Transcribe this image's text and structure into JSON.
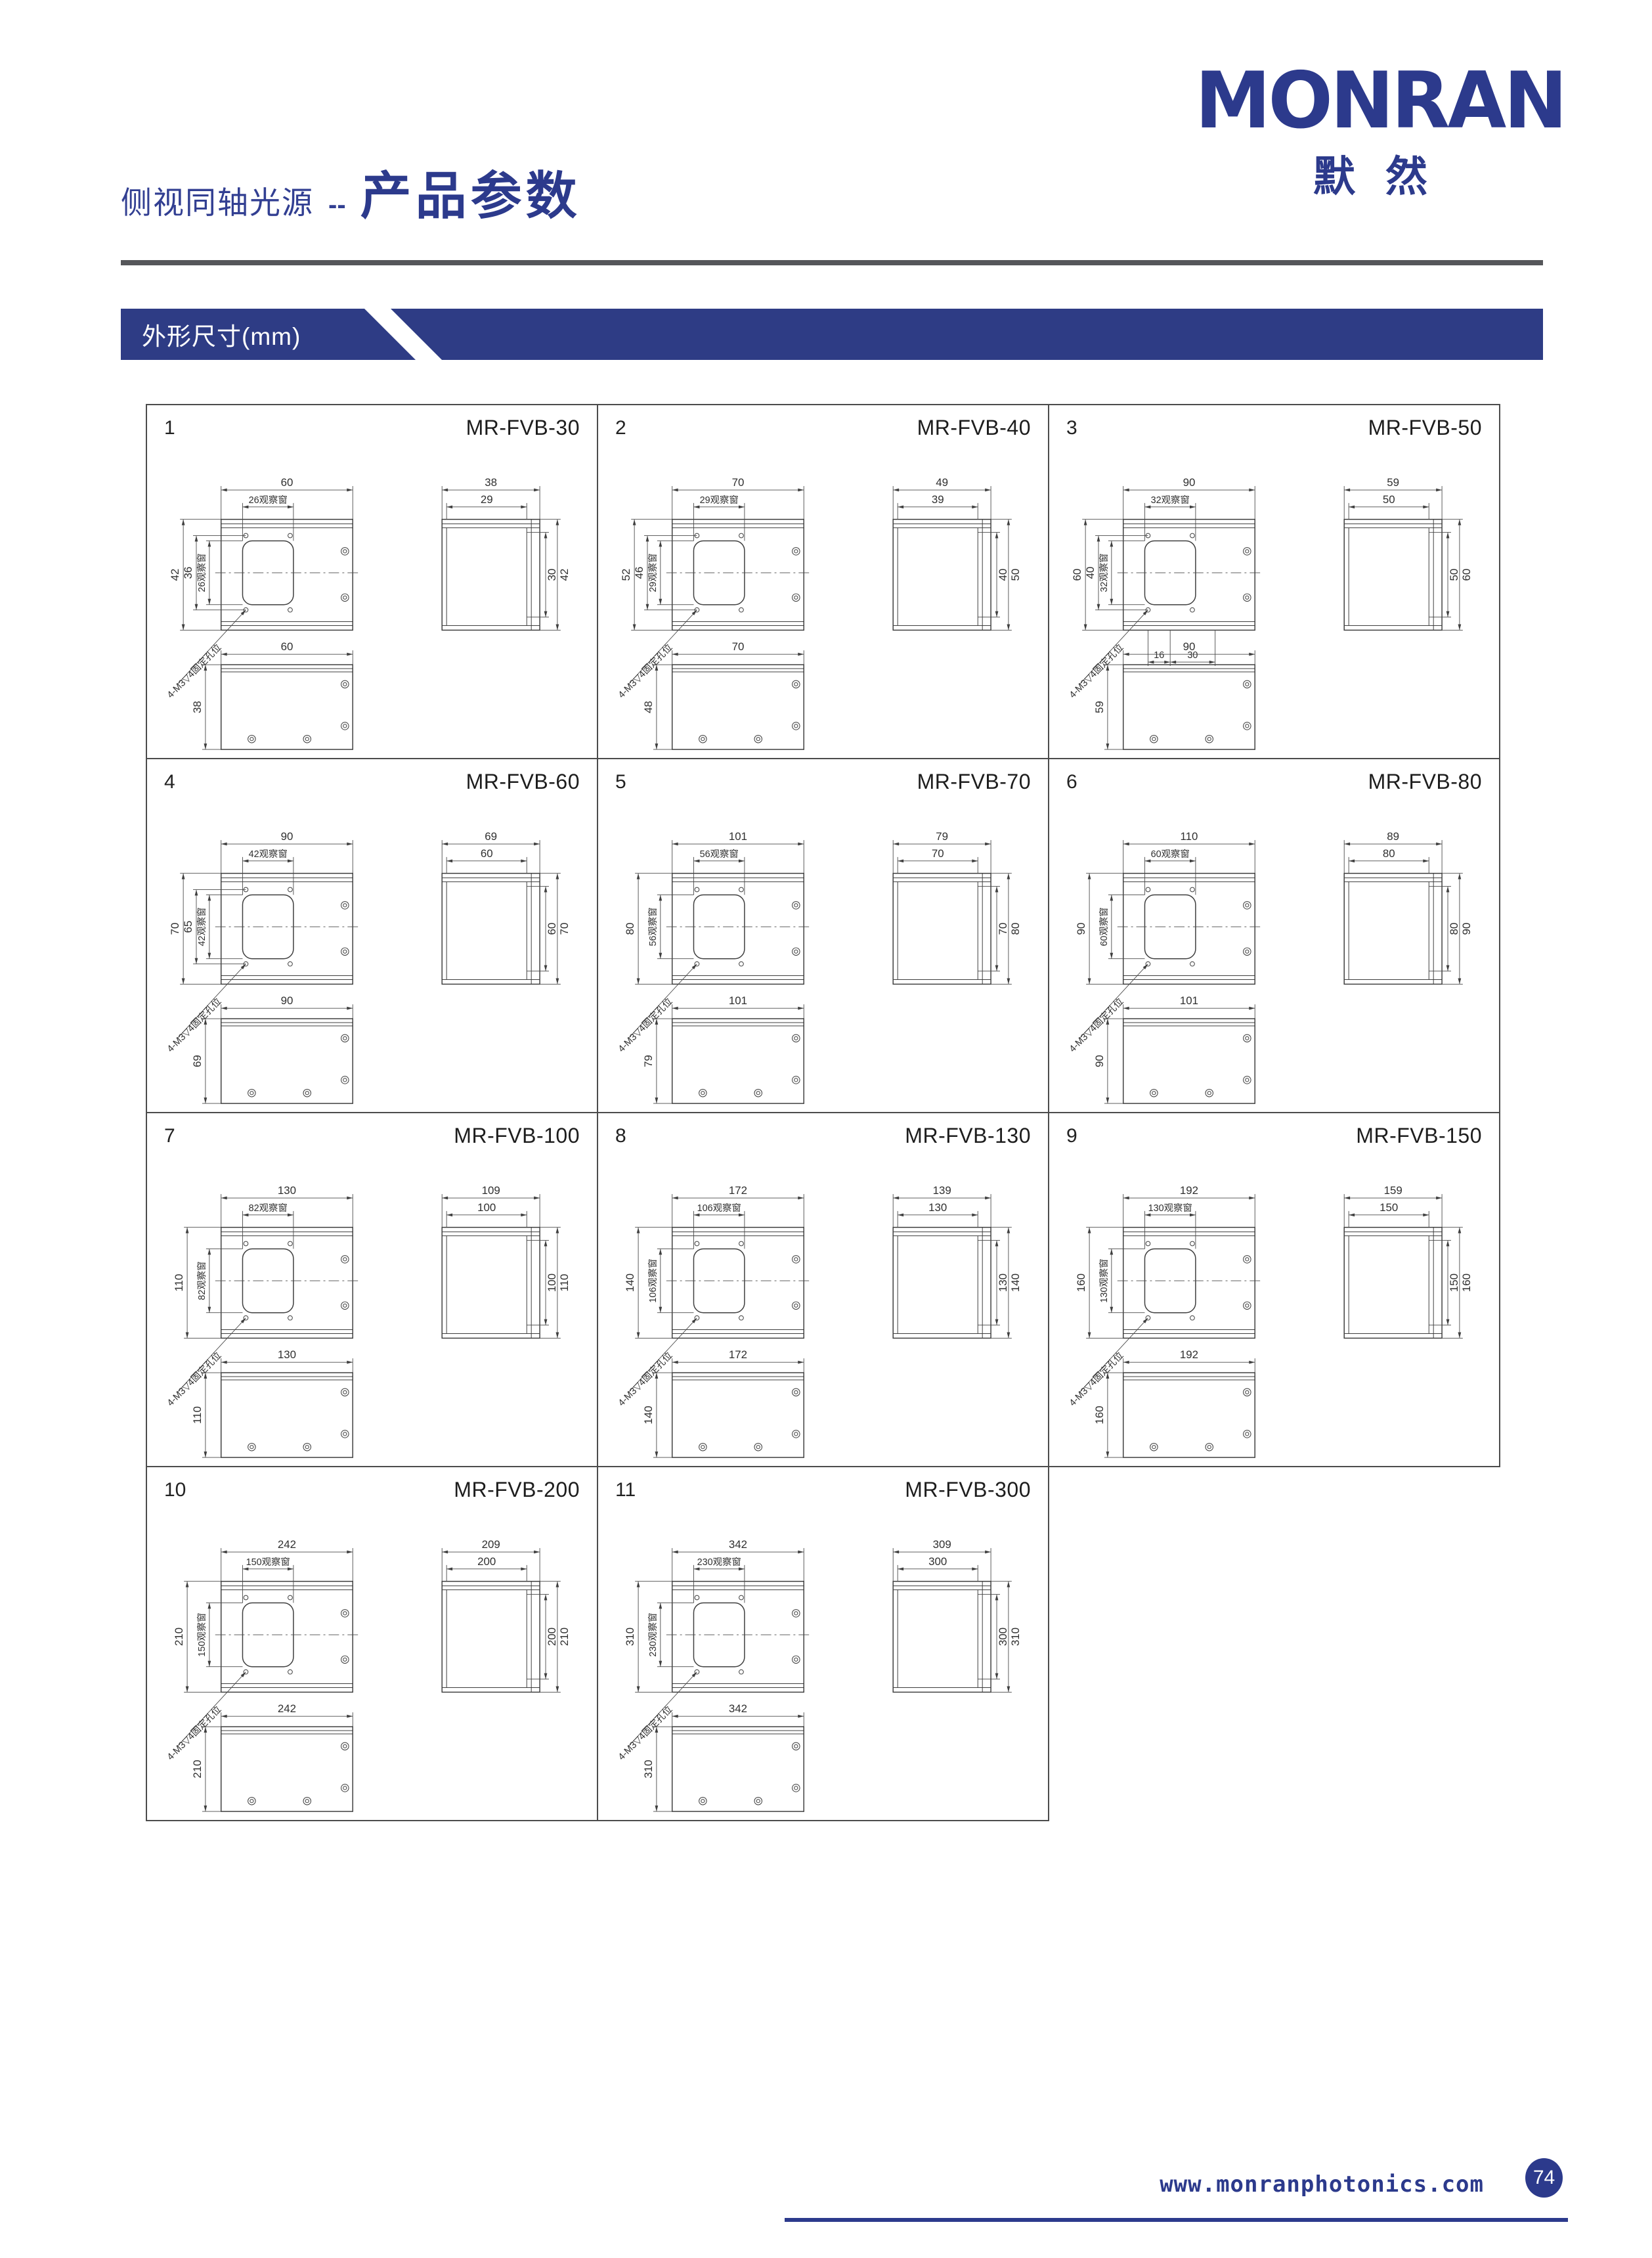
{
  "logo": {
    "wordmark": "MONRAN",
    "cn": "默然",
    "color": "#2c3a8c"
  },
  "header": {
    "category": "侧视同轴光源",
    "separator": "--",
    "title": "产品参数"
  },
  "section": {
    "label": "外形尺寸(mm)"
  },
  "drawing": {
    "leader_label": "4-M3▽4固定孔位",
    "line_color": "#3f3f3f"
  },
  "footer": {
    "website": "www.monranphotonics.com",
    "page_number": "74"
  },
  "cells": [
    {
      "num": "1",
      "model": "MR-FVB-30",
      "front": {
        "width": "60",
        "window": "26观察窗",
        "heights": [
          "42",
          "36"
        ],
        "window_v": "26观察窗"
      },
      "side": {
        "widths": [
          "38",
          "29"
        ],
        "heights": [
          "30",
          "42"
        ]
      },
      "bottom": {
        "width": "60",
        "height": "38"
      }
    },
    {
      "num": "2",
      "model": "MR-FVB-40",
      "front": {
        "width": "70",
        "window": "29观察窗",
        "heights": [
          "52",
          "46"
        ],
        "window_v": "29观察窗"
      },
      "side": {
        "widths": [
          "49",
          "39"
        ],
        "heights": [
          "40",
          "50"
        ]
      },
      "bottom": {
        "width": "70",
        "height": "48"
      }
    },
    {
      "num": "3",
      "model": "MR-FVB-50",
      "front": {
        "width": "90",
        "window": "32观察窗",
        "heights": [
          "60",
          "40"
        ],
        "window_v": "32观察窗",
        "foot": [
          "16",
          "30"
        ]
      },
      "side": {
        "widths": [
          "59",
          "50"
        ],
        "heights": [
          "50",
          "60"
        ]
      },
      "bottom": {
        "width": "90",
        "height": "59"
      }
    },
    {
      "num": "4",
      "model": "MR-FVB-60",
      "front": {
        "width": "90",
        "window": "42观察窗",
        "heights": [
          "70",
          "65"
        ],
        "window_v": "42观察窗"
      },
      "side": {
        "widths": [
          "69",
          "60"
        ],
        "heights": [
          "60",
          "70"
        ]
      },
      "bottom": {
        "width": "90",
        "height": "69"
      }
    },
    {
      "num": "5",
      "model": "MR-FVB-70",
      "front": {
        "width": "101",
        "window": "56观察窗",
        "heights": [
          "80"
        ],
        "window_v": "56观察窗"
      },
      "side": {
        "widths": [
          "79",
          "70"
        ],
        "heights": [
          "70",
          "80"
        ]
      },
      "bottom": {
        "width": "101",
        "height": "79"
      }
    },
    {
      "num": "6",
      "model": "MR-FVB-80",
      "front": {
        "width": "110",
        "window": "60观察窗",
        "heights": [
          "90"
        ],
        "window_v": "60观察窗"
      },
      "side": {
        "widths": [
          "89",
          "80"
        ],
        "heights": [
          "80",
          "90"
        ]
      },
      "bottom": {
        "width": "101",
        "height": "90"
      }
    },
    {
      "num": "7",
      "model": "MR-FVB-100",
      "front": {
        "width": "130",
        "window": "82观察窗",
        "heights": [
          "110"
        ],
        "window_v": "82观察窗"
      },
      "side": {
        "widths": [
          "109",
          "100"
        ],
        "heights": [
          "100",
          "110"
        ]
      },
      "bottom": {
        "width": "130",
        "height": "110"
      }
    },
    {
      "num": "8",
      "model": "MR-FVB-130",
      "front": {
        "width": "172",
        "window": "106观察窗",
        "heights": [
          "140"
        ],
        "window_v": "106观察窗"
      },
      "side": {
        "widths": [
          "139",
          "130"
        ],
        "heights": [
          "130",
          "140"
        ]
      },
      "bottom": {
        "width": "172",
        "height": "140"
      }
    },
    {
      "num": "9",
      "model": "MR-FVB-150",
      "front": {
        "width": "192",
        "window": "130观察窗",
        "heights": [
          "160"
        ],
        "window_v": "130观察窗"
      },
      "side": {
        "widths": [
          "159",
          "150"
        ],
        "heights": [
          "150",
          "160"
        ]
      },
      "bottom": {
        "width": "192",
        "height": "160"
      }
    },
    {
      "num": "10",
      "model": "MR-FVB-200",
      "front": {
        "width": "242",
        "window": "150观察窗",
        "heights": [
          "210"
        ],
        "window_v": "150观察窗"
      },
      "side": {
        "widths": [
          "209",
          "200"
        ],
        "heights": [
          "200",
          "210"
        ]
      },
      "bottom": {
        "width": "242",
        "height": "210"
      }
    },
    {
      "num": "11",
      "model": "MR-FVB-300",
      "front": {
        "width": "342",
        "window": "230观察窗",
        "heights": [
          "310"
        ],
        "window_v": "230观察窗"
      },
      "side": {
        "widths": [
          "309",
          "300"
        ],
        "heights": [
          "300",
          "310"
        ]
      },
      "bottom": {
        "width": "342",
        "height": "310"
      }
    }
  ]
}
